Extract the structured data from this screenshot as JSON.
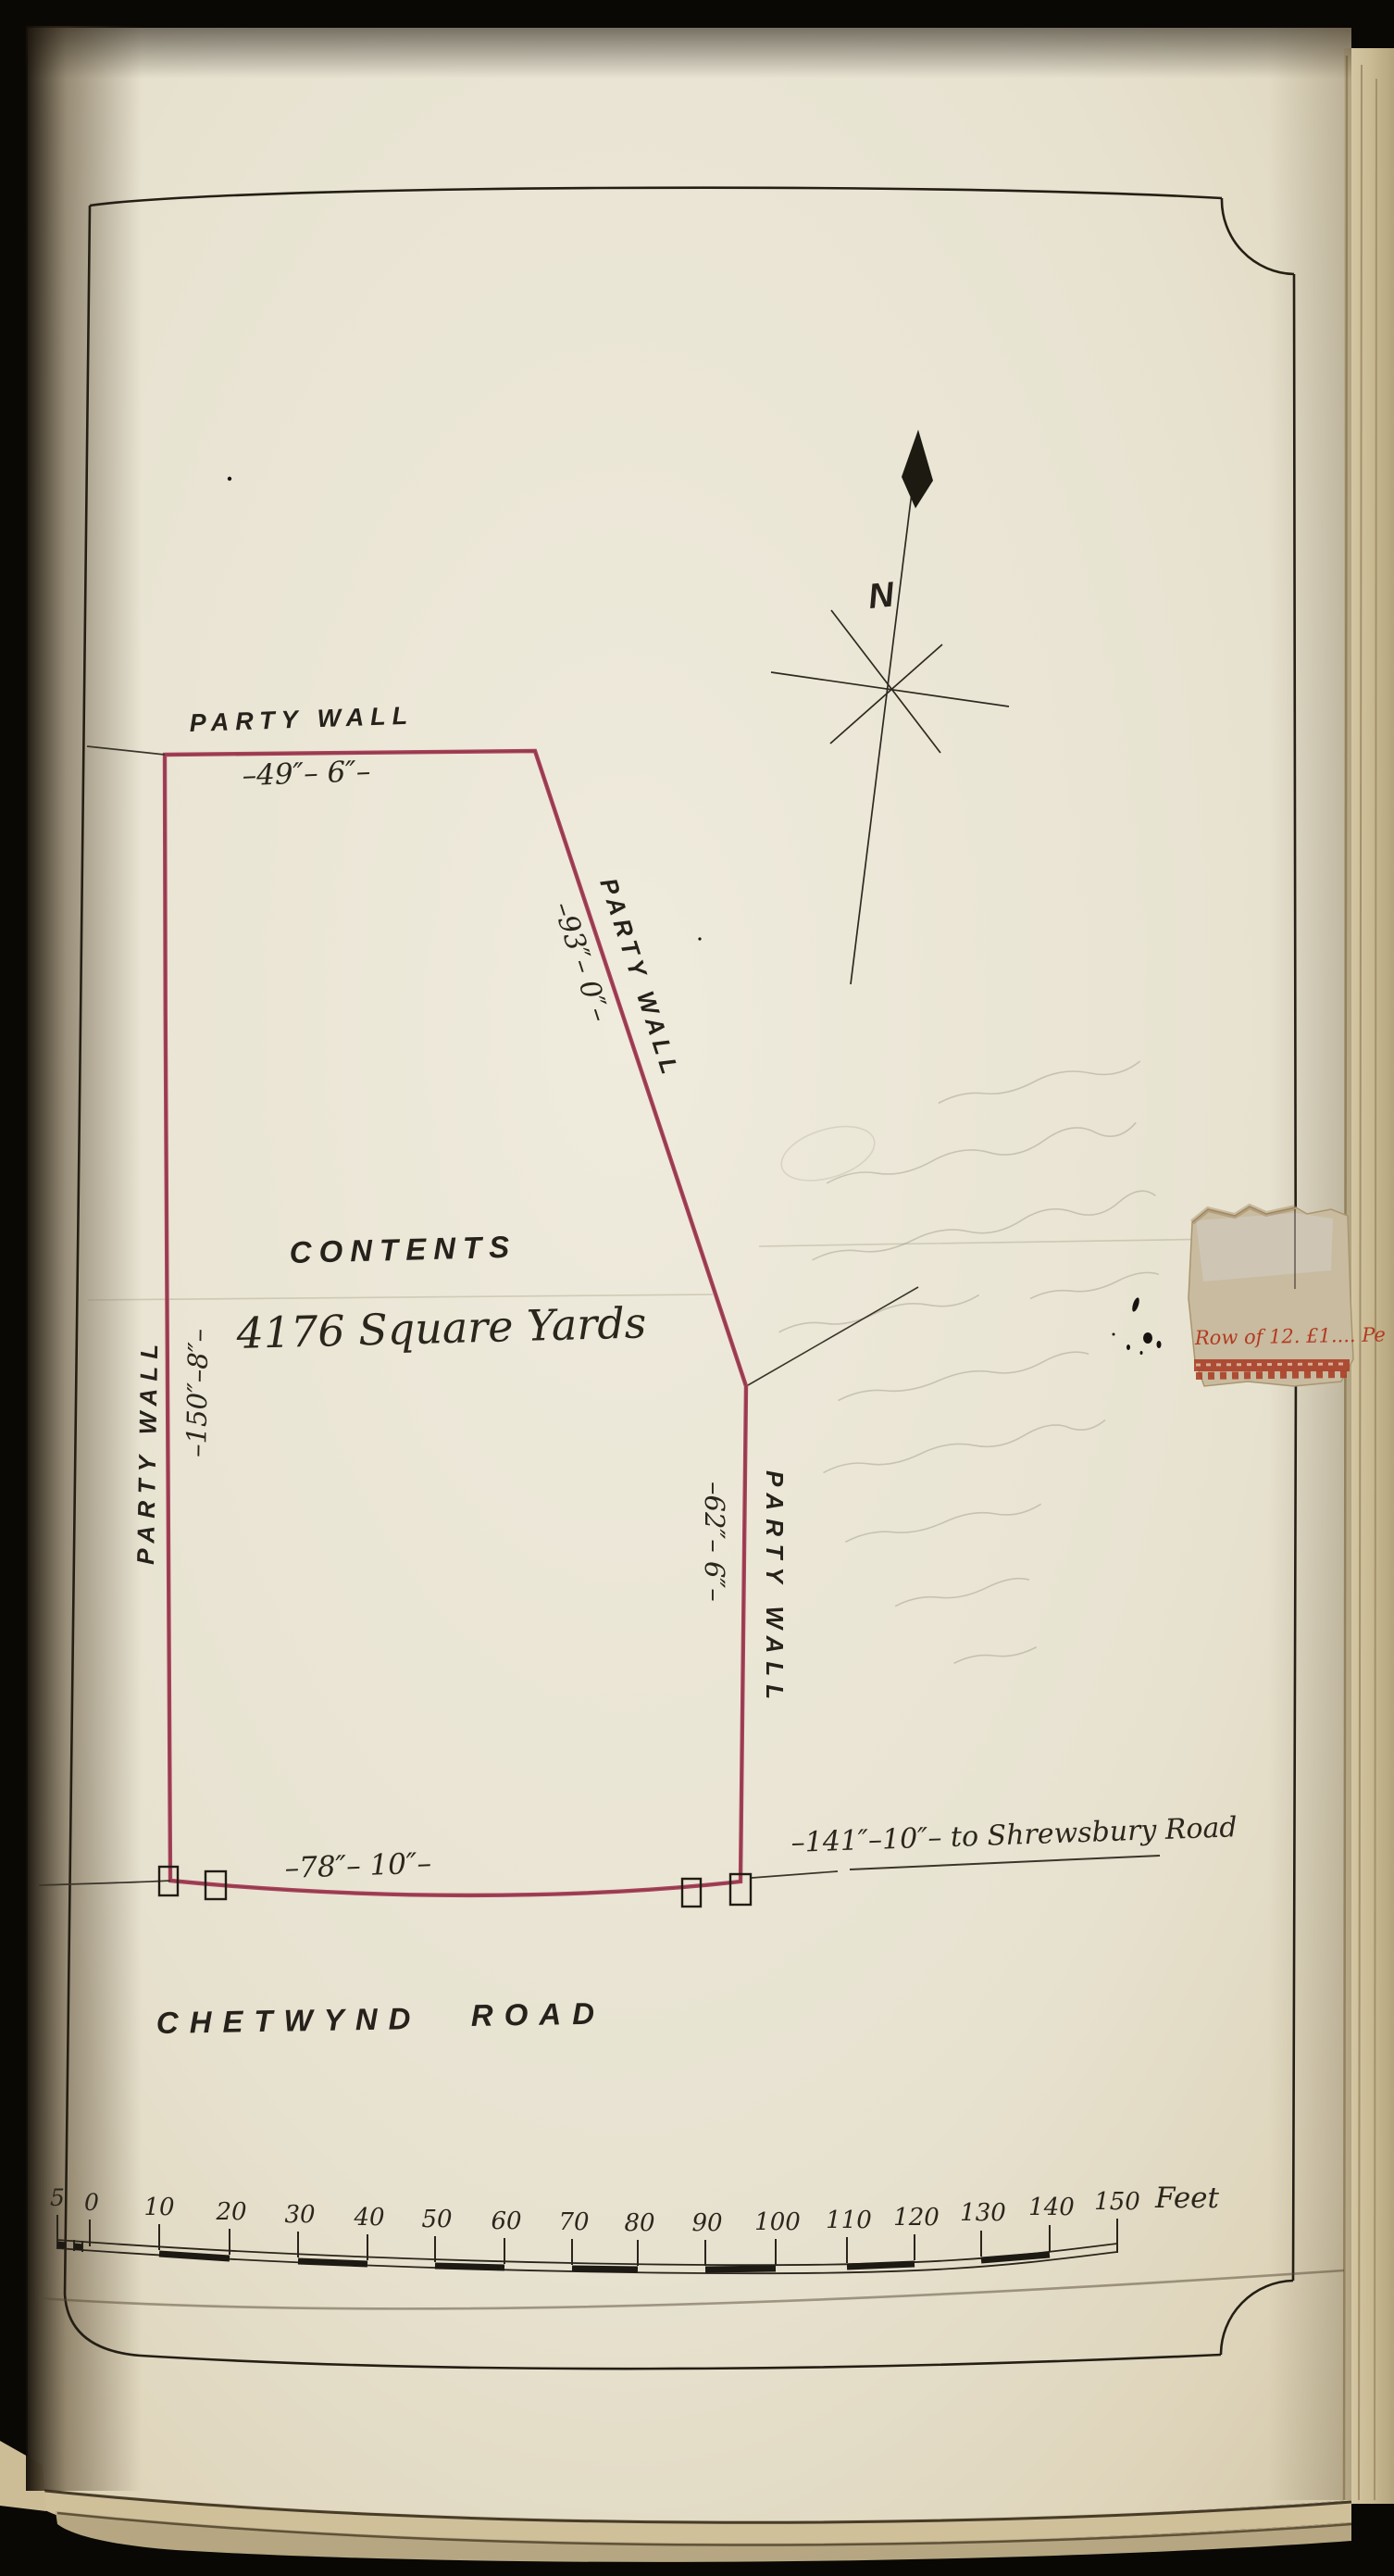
{
  "plan": {
    "labels": {
      "party_wall_top": "PARTY WALL",
      "party_wall_diagonal": "PARTY WALL",
      "party_wall_left": "PARTY WALL",
      "party_wall_right": "PARTY WALL",
      "dim_top": "–49″– 6″–",
      "dim_diagonal": "–93″– 0″–",
      "dim_left": "–150″–8″–",
      "dim_right": "–62″– 6″–",
      "dim_bottom": "–78″– 10″–",
      "dim_to_road": "–141″–10″– to Shrewsbury Road",
      "contents_heading": "CONTENTS",
      "contents_value": "4176 Square Yards",
      "road_name_word1": "CHETWYND",
      "road_name_word2": "ROAD",
      "north_letter": "N"
    },
    "stamp_fragment_text": "Row of 12. £1.... Pe",
    "scale_bar": {
      "unit_label": "Feet",
      "tick_labels": [
        "5",
        "0",
        "10",
        "20",
        "30",
        "40",
        "50",
        "60",
        "70",
        "80",
        "90",
        "100",
        "110",
        "120",
        "130",
        "140",
        "150"
      ]
    },
    "colors": {
      "plot_line": "#a8435a",
      "ink": "#26211a",
      "stamp_red": "#b13b22",
      "paper": "#e9e4d4"
    }
  }
}
